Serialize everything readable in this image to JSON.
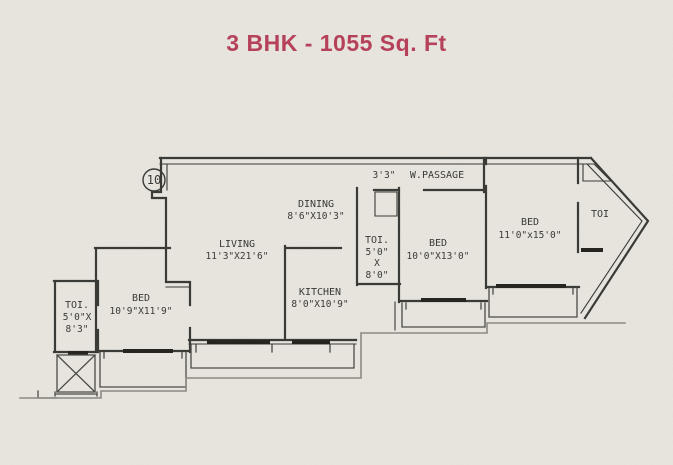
{
  "title": "3 BHK - 1055 Sq. Ft",
  "colors": {
    "accent": "#b5415a",
    "line": "#3a3a36",
    "dark": "#26251f",
    "boundary": "#8b8a82",
    "rail": "#4c4b47",
    "paper": "#eae7e0"
  },
  "plan": {
    "unit_circle_label": "10",
    "passage": {
      "width_label": "3'3\"",
      "name": "W.PASSAGE"
    },
    "rooms": {
      "living": {
        "name": "LIVING",
        "size": "11'3\"X21'6\""
      },
      "dining": {
        "name": "DINING",
        "size": "8'6\"X10'3\""
      },
      "kitchen": {
        "name": "KITCHEN",
        "size": "8'0\"X10'9\""
      },
      "bed_left": {
        "name": "BED",
        "size": "10'9\"X11'9\""
      },
      "bed_mid": {
        "name": "BED",
        "size": "10'0\"X13'0\""
      },
      "bed_right": {
        "name": "BED",
        "size": "11'0\"x15'0\""
      },
      "toi_left": {
        "name": "TOI.",
        "line2": "5'0\"X",
        "line3": "8'3\""
      },
      "toi_mid": {
        "name": "TOI.",
        "line2": "5'0\"",
        "line3": "X",
        "line4": "8'0\""
      },
      "toi_right": {
        "name": "TOI"
      }
    }
  }
}
